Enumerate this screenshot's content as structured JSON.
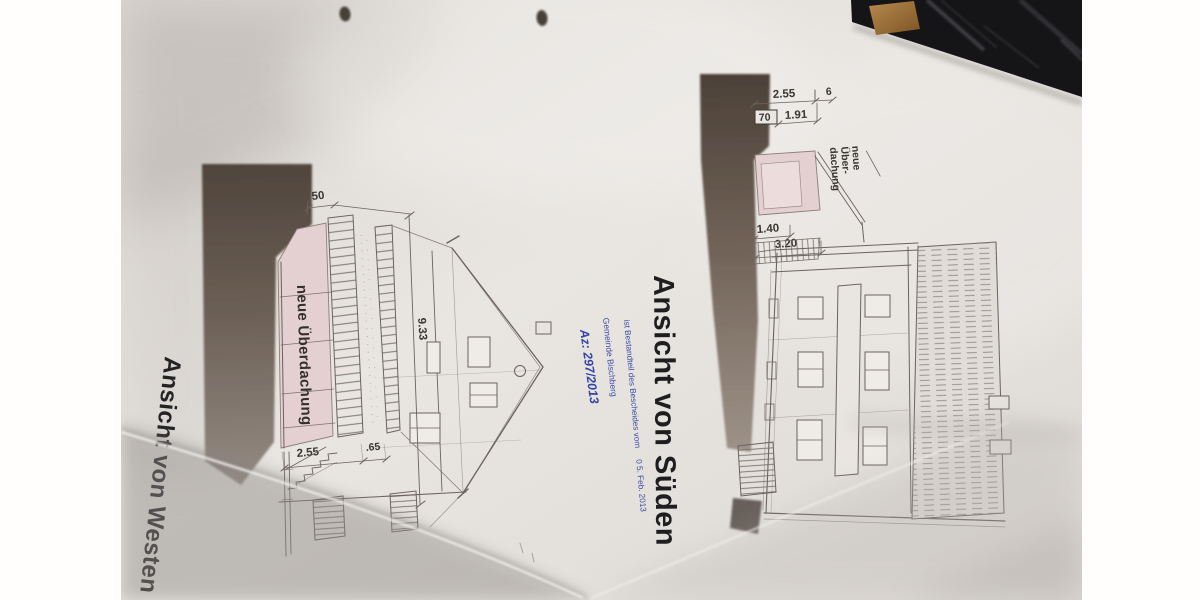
{
  "photo": {
    "description": "Photograph of folded architectural elevation drawings (building permit plans) lying on a desk",
    "colors": {
      "paper": "#e7e4e0",
      "canopy_pink": "#e4cfd1",
      "canopy_pink_inner": "#ecdcdc",
      "stamp_blue": "#3a4aa6",
      "print_shadow_dark": "#50453c",
      "desk_black": "#151517",
      "wood_trim": "#a87c46",
      "line_ink": "#6b635c",
      "title_ink": "#1e1d20"
    }
  },
  "west_elevation": {
    "title": "Ansicht von Westen",
    "canopy_label": "neue Überdachung",
    "dimensions": {
      "ridge_height": "9.33",
      "offset_top": "50",
      "canopy_width": "2.55",
      "step": ".65"
    }
  },
  "south_elevation": {
    "title": "Ansicht von Süden",
    "canopy_label_lines": [
      "neue",
      "Über-",
      "dachung"
    ],
    "dimensions": {
      "top_width": "2.55",
      "top_small": "6",
      "wall_width": "70",
      "canopy_depth": "1.91",
      "stair_width": "1.40",
      "stair_run": "3.20"
    }
  },
  "approval_stamp": {
    "municipality": "Gemeinde Bischberg",
    "note": "ist Bestandteil des Bescheides vom",
    "date": "0 5. Feb. 2013",
    "file_number": "Az: 297/2013"
  }
}
